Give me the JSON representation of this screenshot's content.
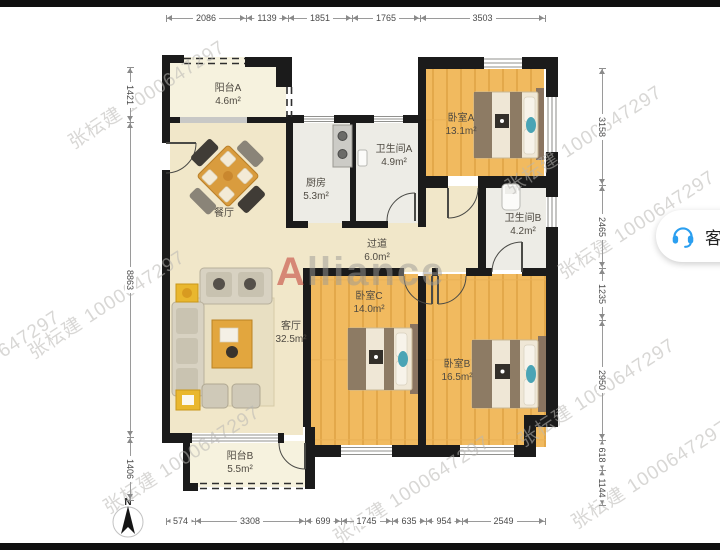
{
  "floor_plan": {
    "brand_watermark": {
      "initial": "A",
      "rest": "lliance"
    },
    "agent_watermark": "张枟建 1000647297",
    "compass_label": "N",
    "rooms": {
      "balcony_a": {
        "name": "阳台A",
        "area": "4.6m²"
      },
      "dining": {
        "name": "餐厅",
        "area": ""
      },
      "kitchen": {
        "name": "厨房",
        "area": "5.3m²"
      },
      "bath_a": {
        "name": "卫生间A",
        "area": "4.9m²"
      },
      "bedroom_a": {
        "name": "卧室A",
        "area": "13.1m²"
      },
      "bath_b": {
        "name": "卫生间B",
        "area": "4.2m²"
      },
      "hallway": {
        "name": "过道",
        "area": "6.0m²"
      },
      "living": {
        "name": "客厅",
        "area": "32.5m²"
      },
      "bedroom_c": {
        "name": "卧室C",
        "area": "14.0m²"
      },
      "bedroom_b": {
        "name": "卧室B",
        "area": "16.5m²"
      },
      "balcony_b": {
        "name": "阳台B",
        "area": "5.5m²"
      }
    },
    "dimensions_mm": {
      "top": [
        "2086",
        "1139",
        "1851",
        "1765",
        "3503"
      ],
      "bottom": [
        "574",
        "3308",
        "699",
        "1745",
        "635",
        "954",
        "2549"
      ],
      "left": [
        "1421",
        "8863",
        "1406"
      ],
      "right": [
        "3158",
        "2465",
        "1235",
        "2950",
        "618",
        "1144"
      ]
    }
  },
  "service_button": {
    "label": "客",
    "icon": "headset-icon"
  },
  "colors": {
    "wall": "#1b1b1b",
    "wood_floor": "#f1ba5f",
    "cream_floor": "#f1e7c9",
    "tile_floor": "#edece6",
    "balcony_floor": "#f6f2de",
    "accent_blue": "#2b9ff0",
    "watermark_red": "#c4473e"
  }
}
